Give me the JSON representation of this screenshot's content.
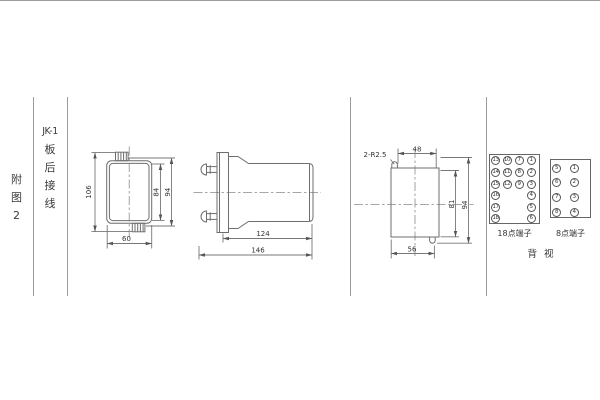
{
  "sheet": {
    "figure_label": {
      "lines": [
        "附",
        "图",
        "2"
      ]
    },
    "title_block": {
      "lines": [
        "JK-1",
        "板",
        "后",
        "接",
        "线"
      ]
    }
  },
  "front_view": {
    "dim_106": "106",
    "dim_84": "84",
    "dim_94": "94",
    "dim_60": "60"
  },
  "side_view": {
    "dim_124": "124",
    "dim_146": "146"
  },
  "panel_view": {
    "slot_label": "2-R2.5",
    "dim_48": "48",
    "dim_81": "81",
    "dim_94": "94",
    "dim_56": "56"
  },
  "terminals": {
    "t18": {
      "label": "18点端子",
      "columns": [
        [
          "13",
          "14",
          "15",
          "16",
          "17",
          "18"
        ],
        [
          "10",
          "11",
          "12"
        ],
        [
          "7",
          "8",
          "9"
        ],
        [
          "1",
          "2",
          "3",
          "4",
          "5",
          "6"
        ]
      ]
    },
    "t8": {
      "label": "8点端子",
      "columns": [
        [
          "5",
          "6",
          "7",
          "8"
        ],
        [
          "1",
          "2",
          "3",
          "4"
        ]
      ]
    },
    "view_label": "背 视"
  },
  "colors": {
    "table_line": "#9c9c9c",
    "drawing_line": "#6e6e6e",
    "text": "#333333"
  }
}
